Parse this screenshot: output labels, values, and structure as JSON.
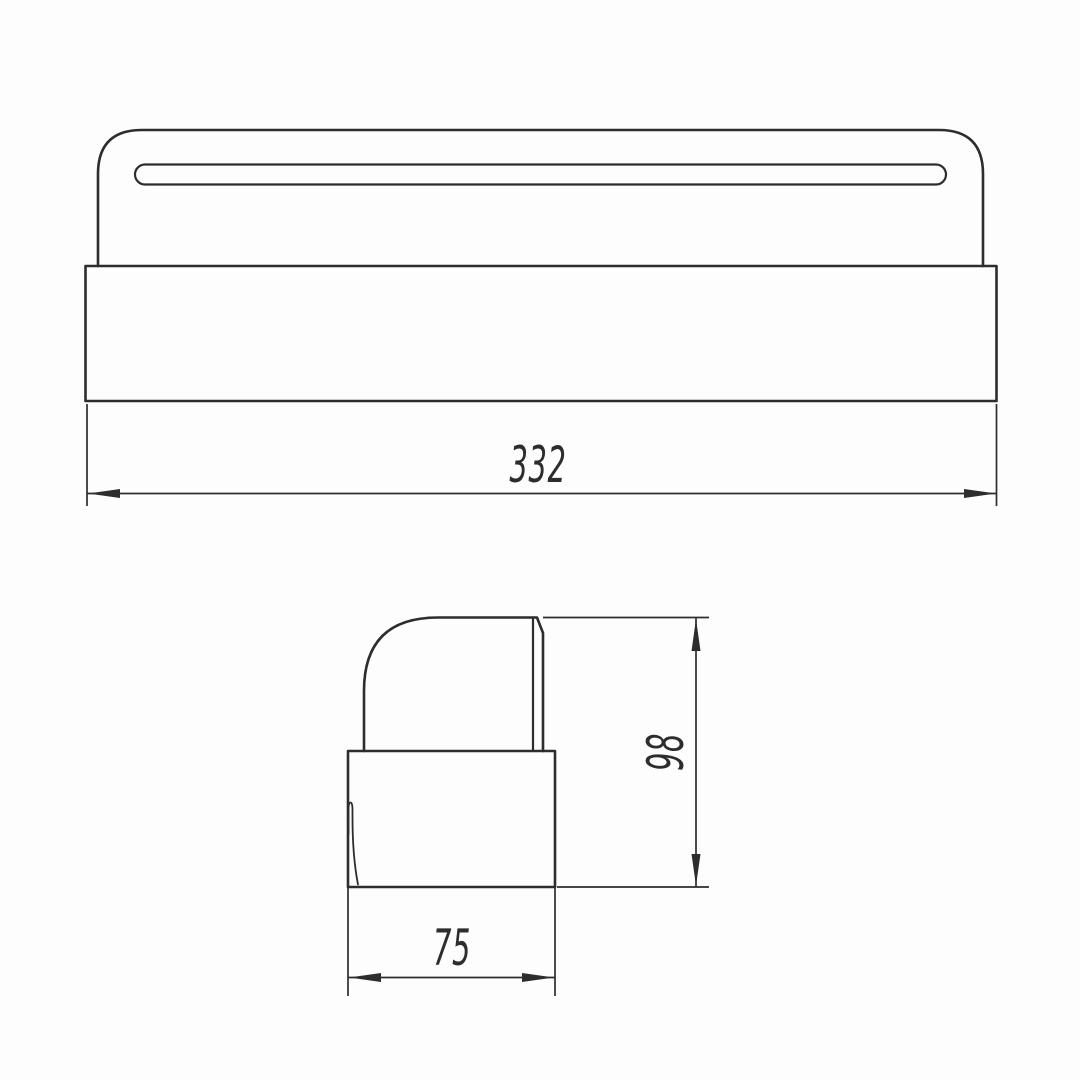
{
  "drawing": {
    "background_color": "#fdfdfd",
    "line_color": "#2d2d2d",
    "views": {
      "front": {
        "name": "front-view",
        "dimension_labels": {
          "width": "332"
        }
      },
      "side": {
        "name": "side-view",
        "dimension_labels": {
          "height": "98",
          "depth": "75"
        }
      }
    }
  }
}
